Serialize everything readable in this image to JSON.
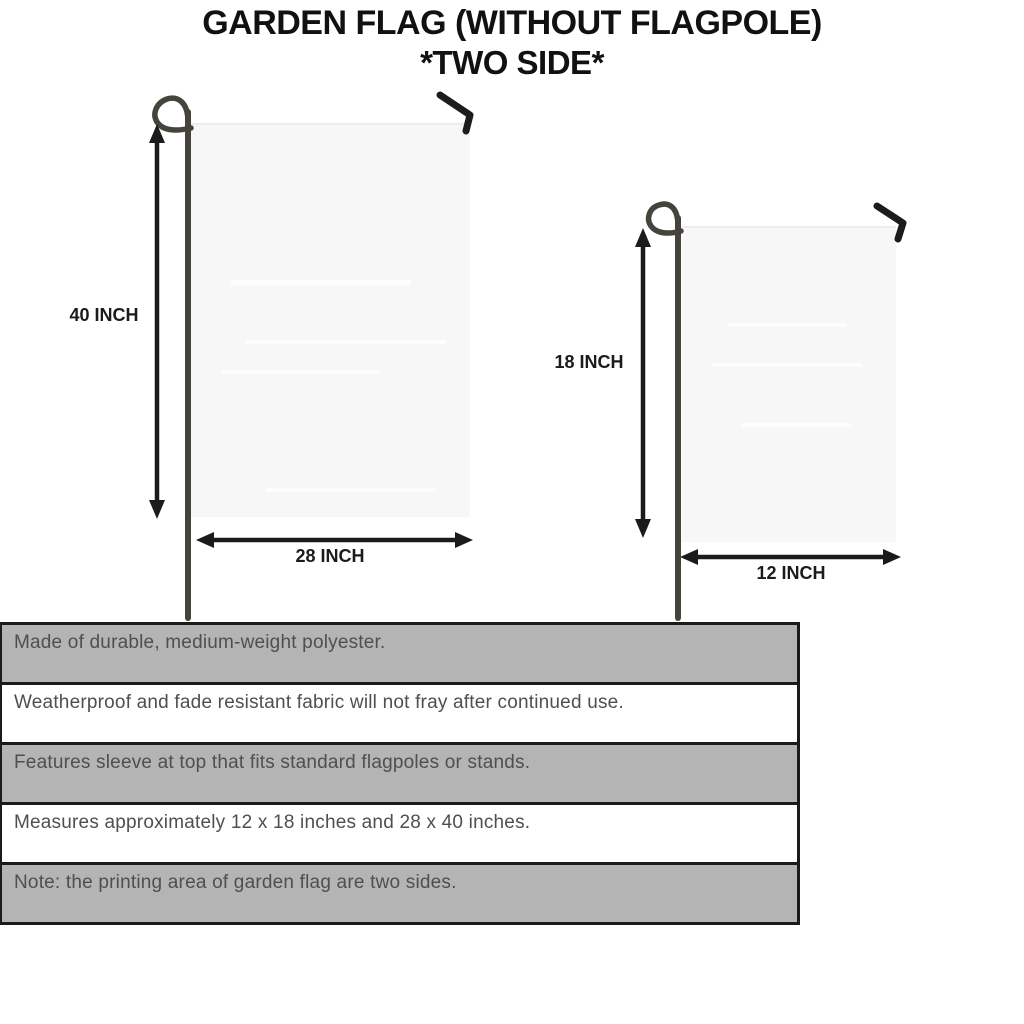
{
  "title": {
    "line1": "GARDEN FLAG (WITHOUT FLAGPOLE)",
    "line2": "*TWO SIDE*"
  },
  "diagram": {
    "large_flag": {
      "name": "garden flag 28 x 40 inches",
      "height_label": "40 INCH",
      "width_label": "28 INCH"
    },
    "small_flag": {
      "name": "garden flag 12 x 18 inches",
      "height_label": "18 INCH",
      "width_label": "12 INCH"
    },
    "icons": {
      "flagpole": "flagpole-rod-with-loop-icon",
      "hook": "hanger-hook-icon",
      "measure_arrow": "double-headed-measure-arrow-icon"
    }
  },
  "spec_table": {
    "rows": [
      "Made of durable, medium-weight polyester.",
      "Weatherproof and fade resistant fabric will not fray after continued use.",
      "Features sleeve at top that fits standard flagpoles or stands.",
      "Measures approximately 12 x 18 inches and 28 x 40 inches.",
      "Note: the printing area of garden flag are two sides."
    ]
  },
  "colors": {
    "title_text": "#111111",
    "arrow_and_labels": "#1b1b1b",
    "pole": "#45433b",
    "flag_fill": "#f7f7f7",
    "table_shaded_row": "#b4b4b4",
    "table_text": "#4f4f4f",
    "table_border": "#1b1b1b"
  }
}
